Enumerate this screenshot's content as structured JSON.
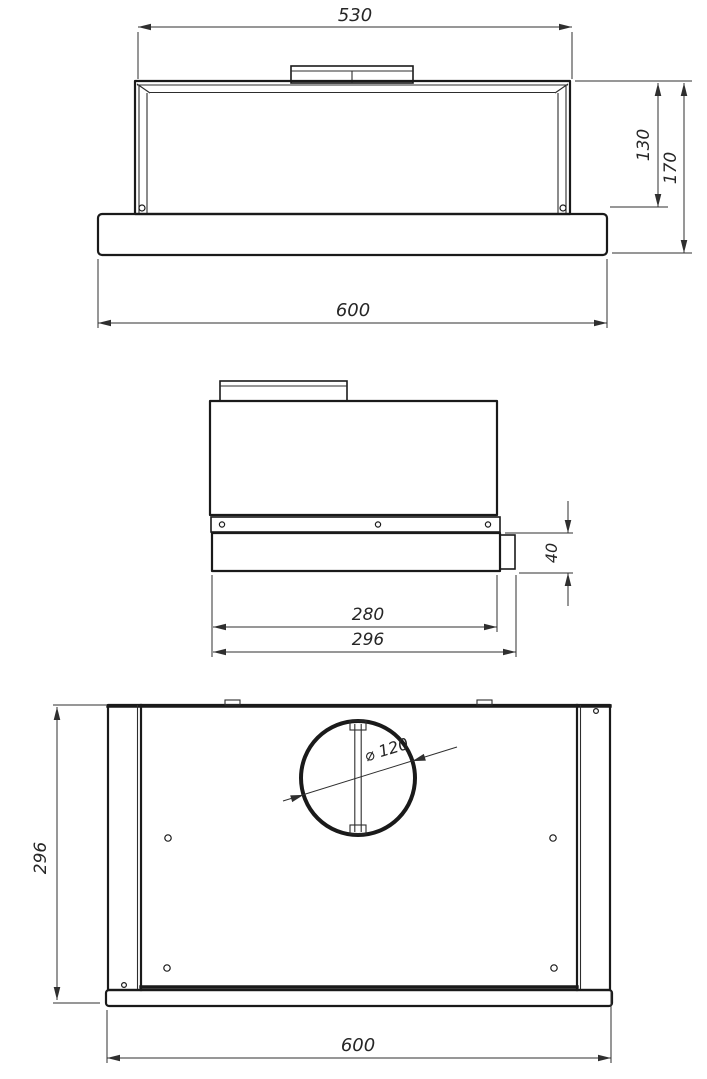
{
  "drawing": {
    "front_view": {
      "top_width": "530",
      "body_height": "130",
      "total_height": "170",
      "bottom_width": "600"
    },
    "side_view": {
      "panel_height": "40",
      "body_depth": "280",
      "total_depth": "296"
    },
    "plan_view": {
      "depth": "296",
      "width": "600",
      "duct_diameter": "⌀ 120"
    }
  }
}
